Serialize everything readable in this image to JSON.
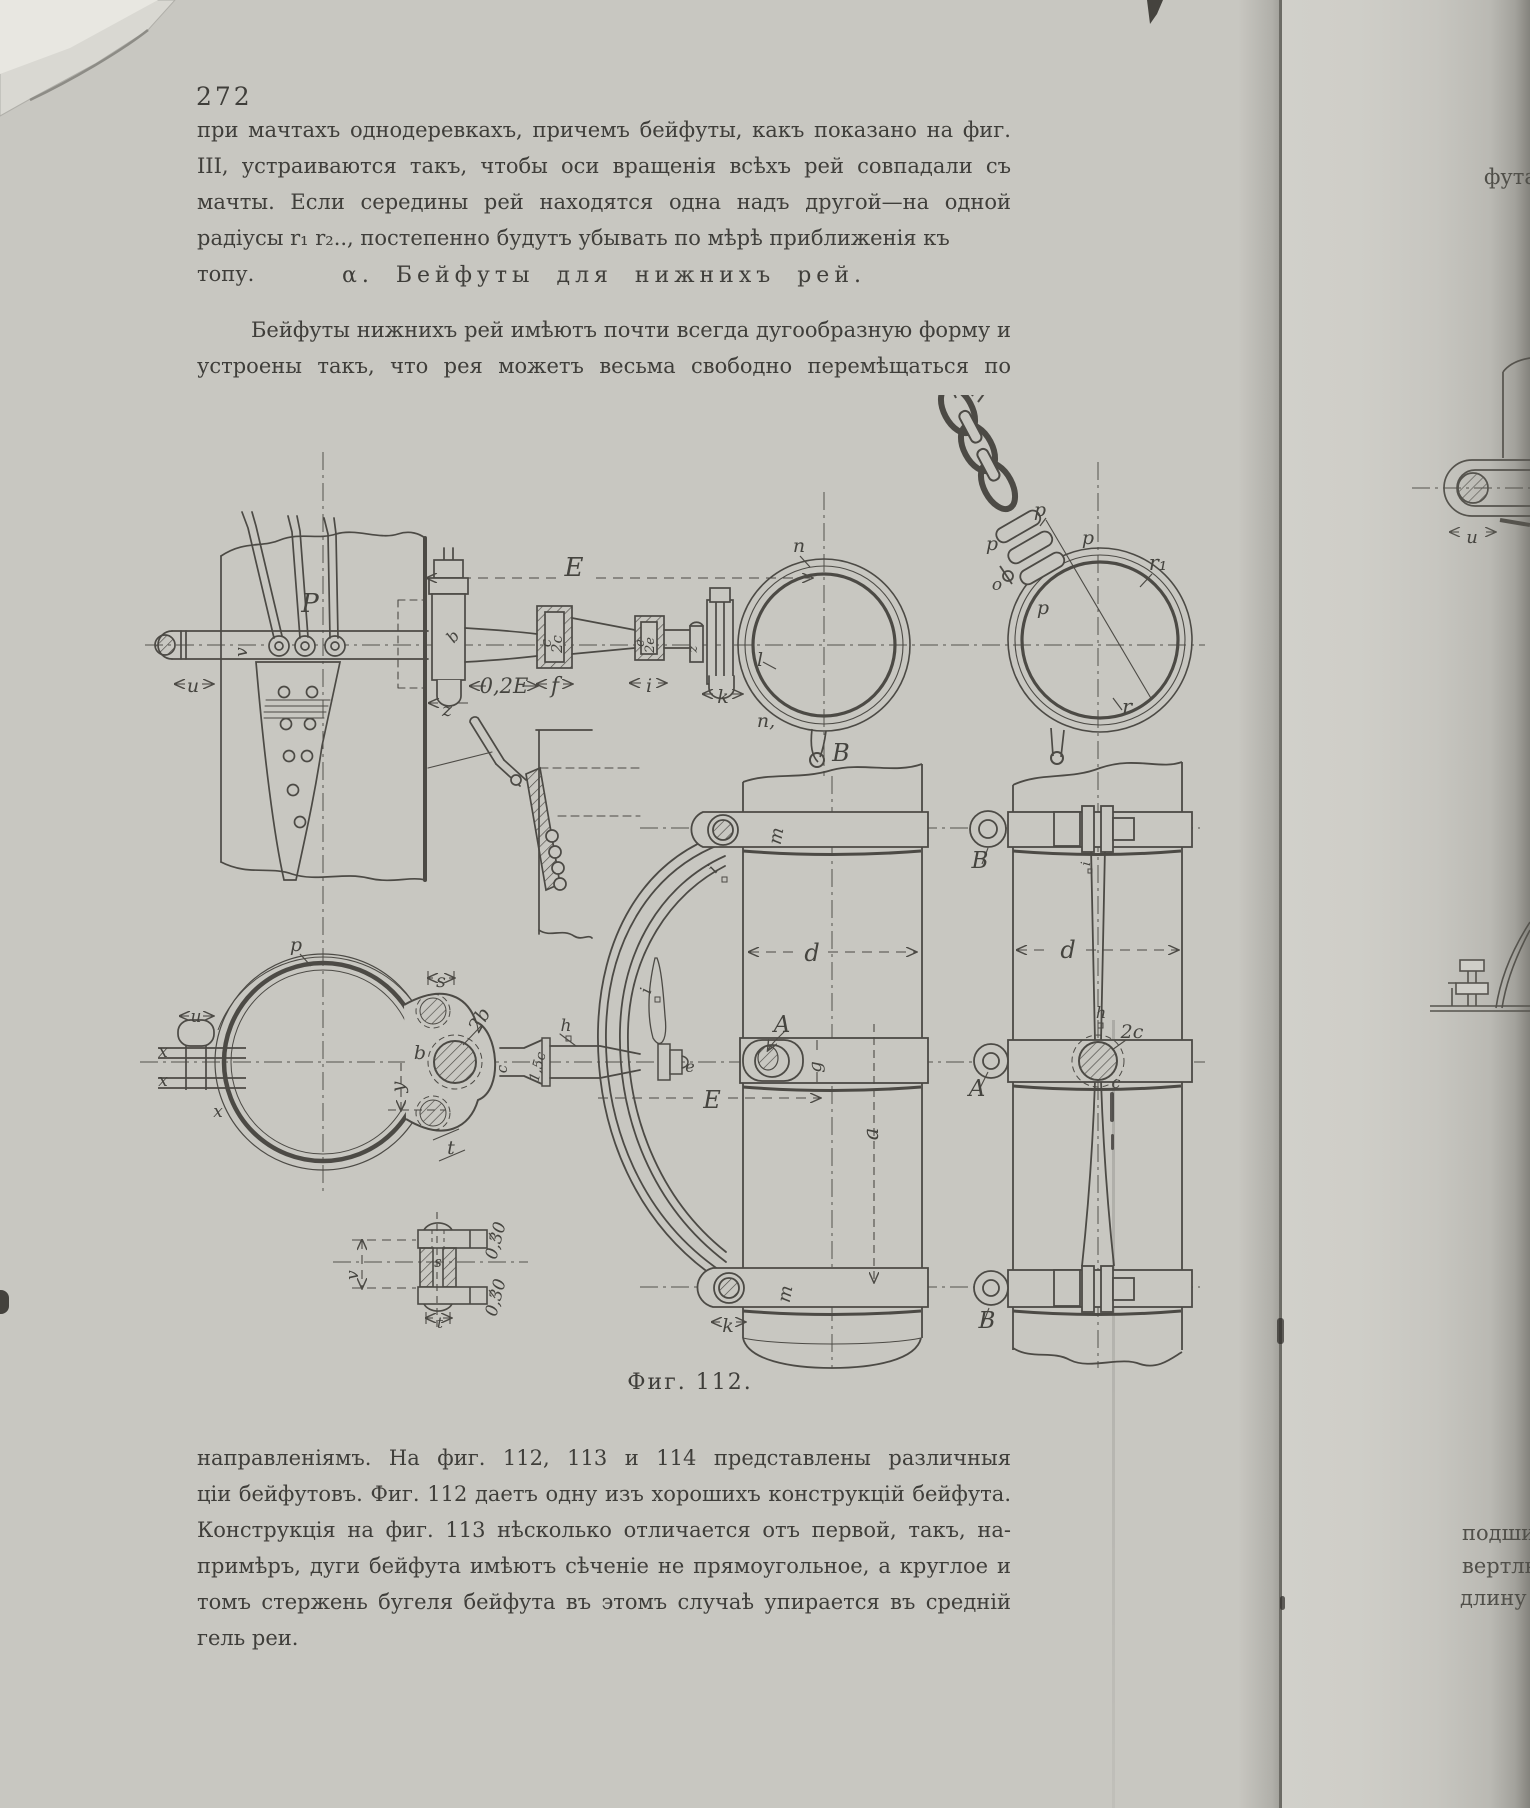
{
  "page": {
    "number": "272",
    "paragraph1": [
      "при мачтахъ однодеревкахъ, причемъ бейфуты, какъ показано на фиг. 111",
      "III, устраиваются такъ, чтобы оси вращенія всѣхъ рей совпадали съ осью",
      "мачты. Если середины рей находятся одна надъ другой—на одной прямой, то",
      "радіусы r₁ r₂.., постепенно будутъ убывать по мѣрѣ приближенія къ топу."
    ],
    "heading": "α. Бейфуты для нижнихъ рей.",
    "paragraph2": [
      "Бейфуты нижнихъ рей имѣютъ почти всегда дугообразную форму и",
      "устроены такъ, что рея можетъ весьма свободно перемѣщаться по всѣмъ"
    ],
    "caption": "Фиг. 112.",
    "paragraph3": [
      "направленіямъ. На фиг. 112, 113 и 114 представлены различныя конструк-",
      "ціи бейфутовъ. Фиг. 112 даетъ одну изъ хорошихъ конструкцій бейфута.",
      "Конструкція на фиг. 113 нѣсколько отличается отъ первой, такъ, на-",
      "примѣръ, дуги бейфута имѣютъ сѣченіе не прямоугольное, а круглое и при-",
      "томъ стержень бугеля бейфута въ этомъ случаѣ упирается въ средній бу-",
      "гель реи."
    ]
  },
  "adjacent_page": {
    "top_fragment": "фута",
    "bottom_fragment1": "подшип",
    "bottom_fragment2": "вертлю",
    "bottom_fragment3": "длину"
  },
  "figure": {
    "labels": [
      {
        "t": "P",
        "x": 310,
        "y": 612,
        "s": 26
      },
      {
        "t": "u",
        "x": 193,
        "y": 692,
        "s": 19
      },
      {
        "t": "v",
        "x": 247,
        "y": 652,
        "r": -90,
        "s": 17
      },
      {
        "t": "E",
        "x": 574,
        "y": 576,
        "s": 26
      },
      {
        "t": "0,2E",
        "x": 504,
        "y": 693,
        "s": 21
      },
      {
        "t": "z",
        "x": 447,
        "y": 716,
        "s": 19
      },
      {
        "t": "f",
        "x": 555,
        "y": 693,
        "s": 22
      },
      {
        "t": "c",
        "x": 551,
        "y": 643,
        "r": -90,
        "s": 15
      },
      {
        "t": "2c",
        "x": 562,
        "y": 644,
        "r": -90,
        "s": 15
      },
      {
        "t": "i",
        "x": 649,
        "y": 692,
        "s": 19
      },
      {
        "t": "e",
        "x": 644,
        "y": 643,
        "r": -90,
        "s": 13
      },
      {
        "t": "2e",
        "x": 654,
        "y": 645,
        "r": -90,
        "s": 13
      },
      {
        "t": "z",
        "x": 697,
        "y": 649,
        "r": -90,
        "s": 13
      },
      {
        "t": "k",
        "x": 723,
        "y": 703,
        "s": 19
      },
      {
        "t": "b",
        "x": 457,
        "y": 640,
        "r": -50,
        "s": 16
      },
      {
        "t": "l",
        "x": 760,
        "y": 666,
        "s": 19
      },
      {
        "t": "n",
        "x": 799,
        "y": 552,
        "s": 19
      },
      {
        "t": "n,",
        "x": 766,
        "y": 727,
        "s": 19
      },
      {
        "t": "B",
        "x": 841,
        "y": 761,
        "s": 24
      },
      {
        "t": "p",
        "x": 1040,
        "y": 516,
        "s": 19
      },
      {
        "t": "p",
        "x": 1088,
        "y": 544,
        "s": 19
      },
      {
        "t": "p",
        "x": 992,
        "y": 550,
        "s": 19
      },
      {
        "t": "p",
        "x": 1043,
        "y": 614,
        "s": 19
      },
      {
        "t": "o",
        "x": 997,
        "y": 590,
        "s": 17
      },
      {
        "t": "r₁",
        "x": 1158,
        "y": 570,
        "s": 21
      },
      {
        "t": "r",
        "x": 1127,
        "y": 714,
        "s": 21
      },
      {
        "t": "p",
        "x": 296,
        "y": 951,
        "s": 19
      },
      {
        "t": "u",
        "x": 196,
        "y": 1022,
        "s": 17
      },
      {
        "t": "x",
        "x": 163,
        "y": 1057,
        "s": 17
      },
      {
        "t": "x",
        "x": 163,
        "y": 1086,
        "s": 17
      },
      {
        "t": "x",
        "x": 218,
        "y": 1117,
        "s": 17
      },
      {
        "t": "s",
        "x": 441,
        "y": 987,
        "s": 19
      },
      {
        "t": "2b",
        "x": 485,
        "y": 1023,
        "r": -60,
        "s": 19
      },
      {
        "t": "b",
        "x": 420,
        "y": 1059,
        "s": 19
      },
      {
        "t": "y",
        "x": 404,
        "y": 1087,
        "r": -90,
        "s": 19
      },
      {
        "t": "t",
        "x": 451,
        "y": 1154,
        "s": 19
      },
      {
        "t": "c",
        "x": 507,
        "y": 1069,
        "r": -90,
        "s": 15
      },
      {
        "t": "1,5c",
        "x": 542,
        "y": 1068,
        "r": -75,
        "s": 14
      },
      {
        "t": "h",
        "x": 566,
        "y": 1031,
        "s": 17
      },
      {
        "t": "e",
        "x": 690,
        "y": 1072,
        "s": 16
      },
      {
        "t": "E",
        "x": 712,
        "y": 1108,
        "s": 24
      },
      {
        "t": "i",
        "x": 717,
        "y": 872,
        "r": -55,
        "s": 16
      },
      {
        "t": "i",
        "x": 651,
        "y": 992,
        "r": -75,
        "s": 16
      },
      {
        "t": "m",
        "x": 782,
        "y": 837,
        "r": -80,
        "s": 18
      },
      {
        "t": "m",
        "x": 791,
        "y": 1295,
        "r": -80,
        "s": 18
      },
      {
        "t": "k",
        "x": 728,
        "y": 1332,
        "s": 19
      },
      {
        "t": "d",
        "x": 812,
        "y": 961,
        "s": 24
      },
      {
        "t": "a",
        "x": 878,
        "y": 1134,
        "r": -90,
        "s": 21
      },
      {
        "t": "A",
        "x": 782,
        "y": 1032,
        "s": 23
      },
      {
        "t": "g",
        "x": 821,
        "y": 1067,
        "r": -90,
        "s": 18
      },
      {
        "t": "B",
        "x": 980,
        "y": 868,
        "s": 23
      },
      {
        "t": "A",
        "x": 977,
        "y": 1096,
        "s": 23
      },
      {
        "t": "B",
        "x": 987,
        "y": 1328,
        "s": 23
      },
      {
        "t": "d",
        "x": 1068,
        "y": 958,
        "s": 24
      },
      {
        "t": "i",
        "x": 1090,
        "y": 864,
        "r": -85,
        "s": 13
      },
      {
        "t": "h",
        "x": 1101,
        "y": 1018,
        "s": 16
      },
      {
        "t": "2c",
        "x": 1132,
        "y": 1038,
        "s": 19
      },
      {
        "t": "c",
        "x": 1116,
        "y": 1088,
        "s": 16
      },
      {
        "t": "0,30",
        "x": 501,
        "y": 1242,
        "r": -75,
        "s": 17
      },
      {
        "t": "0,30",
        "x": 501,
        "y": 1299,
        "r": -75,
        "s": 17
      },
      {
        "t": "v",
        "x": 358,
        "y": 1275,
        "r": -90,
        "s": 17
      },
      {
        "t": "s",
        "x": 438,
        "y": 1267,
        "s": 15
      },
      {
        "t": "t",
        "x": 440,
        "y": 1328,
        "s": 15
      },
      {
        "t": "u",
        "x": 1472,
        "y": 543,
        "s": 18
      }
    ]
  },
  "colors": {
    "paper": "#c8c7c1",
    "ink": "#3f3e3a",
    "line": "#4c4a45"
  }
}
